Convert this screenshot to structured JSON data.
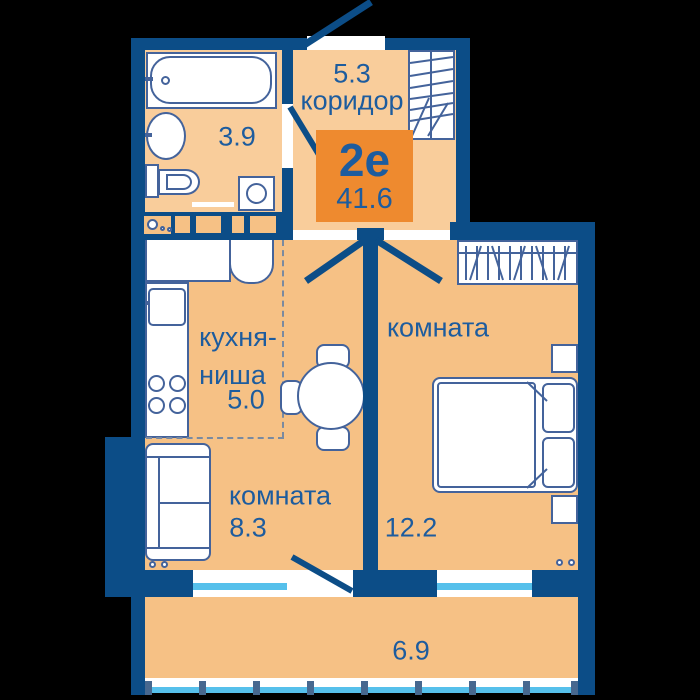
{
  "plan": {
    "badge": {
      "plan_type": "2е",
      "total_area": "41.6"
    },
    "rooms": {
      "corridor": {
        "area": "5.3",
        "name": "коридор"
      },
      "bathroom": {
        "area": "3.9"
      },
      "kitchen_niche": {
        "name_line1": "кухня-",
        "name_line2": "ниша",
        "area": "5.0"
      },
      "room_1": {
        "name": "комната",
        "area": "8.3"
      },
      "room_2": {
        "name": "комната",
        "area": "12.2"
      },
      "balcony": {
        "area": "6.9"
      }
    }
  },
  "colors": {
    "bg": "#000000",
    "wall": "#0c4d87",
    "floor": "#f6c185",
    "floor_light": "#f9cd9b",
    "badge": "#ee8a2f",
    "text": "#1d5c9e",
    "outline": "#44639b",
    "glass": "#56c0eb",
    "post": "#47688f",
    "dash": "#7a8aa0"
  }
}
